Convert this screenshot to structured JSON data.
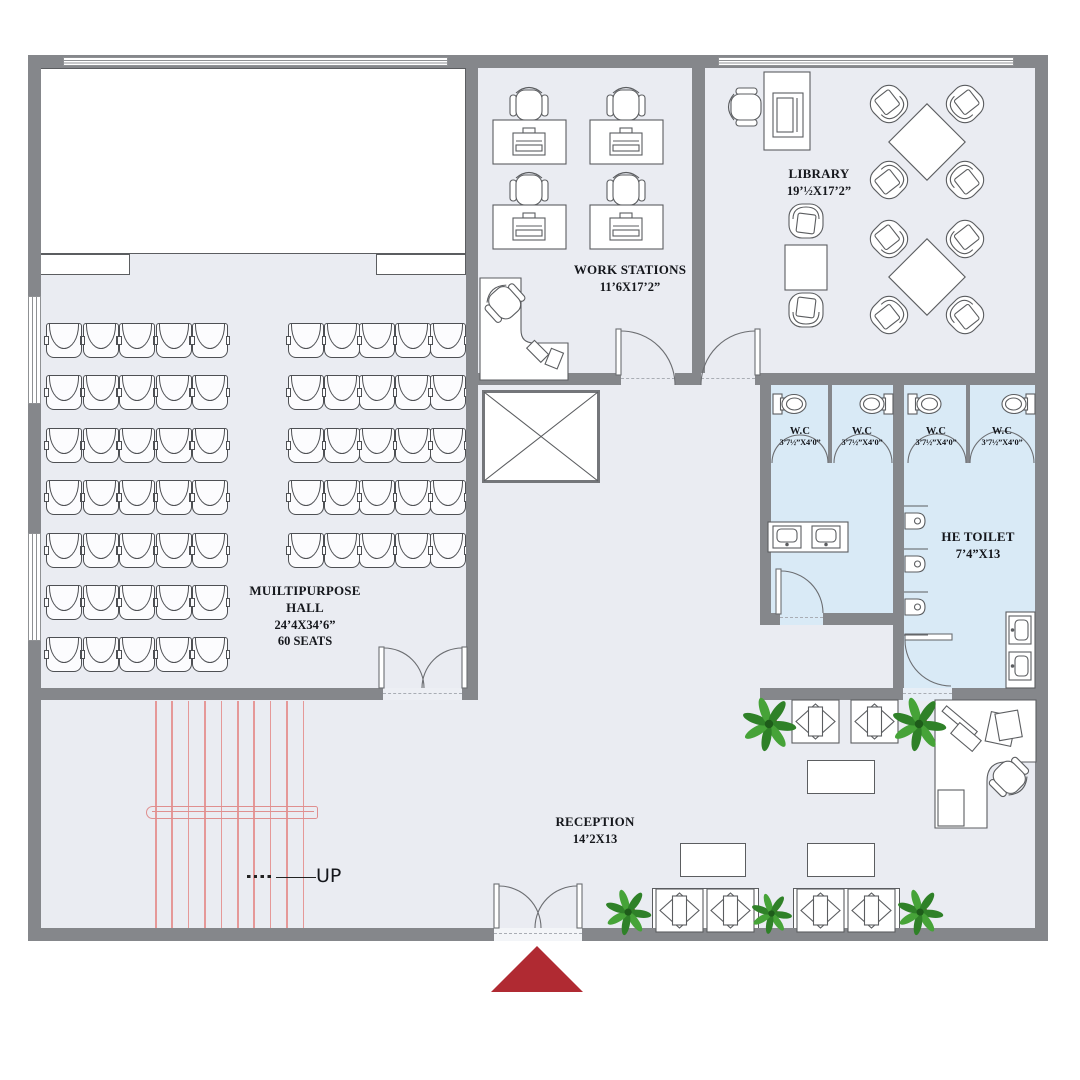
{
  "floor_plan": {
    "rooms": {
      "multipurpose_hall": {
        "name_line1": "MUILTIPURPOSE",
        "name_line2": "HALL",
        "dimensions": "24’4X34’6”",
        "capacity": "60 SEATS"
      },
      "work_stations": {
        "name": "WORK STATIONS",
        "dimensions": "11’6X17’2”"
      },
      "library": {
        "name": "LIBRARY",
        "dimensions": "19’½X17’2”"
      },
      "he_toilet": {
        "name": "HE TOILET",
        "dimensions": "7’4”X13"
      },
      "reception": {
        "name": "RECEPTION",
        "dimensions": "14’2X13"
      },
      "wc_stalls": {
        "name": "W.C",
        "dimensions": "3’7½”X4’0”",
        "count": 4
      }
    },
    "stairs": {
      "label": "UP",
      "steps": 10
    },
    "hall_seating": {
      "left_rows": 7,
      "right_rows": 5,
      "seats_per_row": 5,
      "total_seats": 60
    },
    "colors": {
      "wall": "#85878b",
      "floor": "#eaecf2",
      "toilet_floor": "#d9eaf6",
      "furniture_line": "#5b5d60",
      "stair_line": "#e59898",
      "entrance_marker": "#b02a32",
      "plant_green": "#2f8128",
      "plant_pot": "#7e3a22"
    }
  }
}
